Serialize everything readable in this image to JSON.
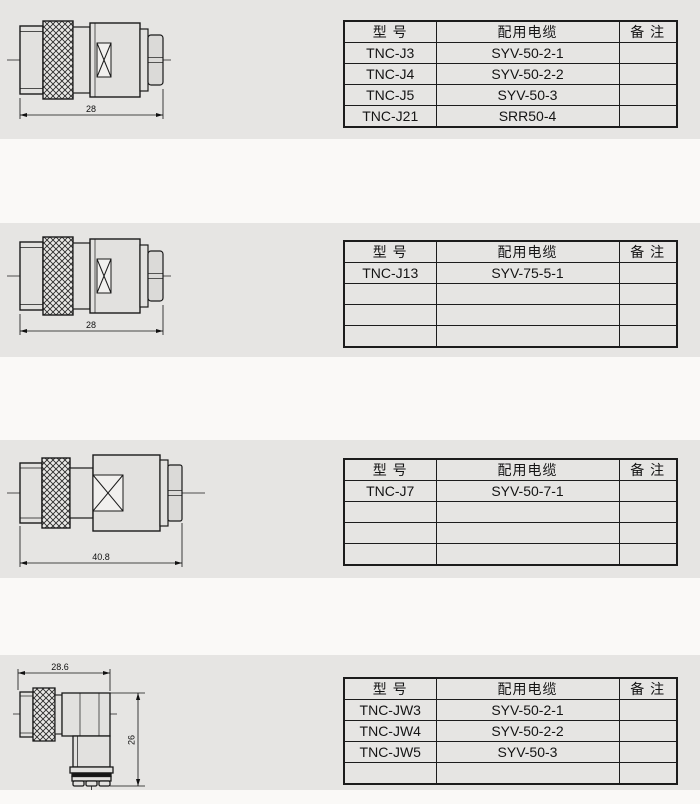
{
  "table_header": {
    "model": "型  号",
    "cable": "配用电缆",
    "remark": "备  注"
  },
  "sections": [
    {
      "drawing": {
        "kind": "straight-connector",
        "length": "28"
      },
      "rows": [
        {
          "model": "TNC-J3",
          "cable": "SYV-50-2-1",
          "remark": ""
        },
        {
          "model": "TNC-J4",
          "cable": "SYV-50-2-2",
          "remark": ""
        },
        {
          "model": "TNC-J5",
          "cable": "SYV-50-3",
          "remark": ""
        },
        {
          "model": "TNC-J21",
          "cable": "SRR50-4",
          "remark": ""
        }
      ]
    },
    {
      "drawing": {
        "kind": "straight-connector",
        "length": "28"
      },
      "rows": [
        {
          "model": "TNC-J13",
          "cable": "SYV-75-5-1",
          "remark": ""
        },
        {
          "model": "",
          "cable": "",
          "remark": ""
        },
        {
          "model": "",
          "cable": "",
          "remark": ""
        },
        {
          "model": "",
          "cable": "",
          "remark": ""
        }
      ]
    },
    {
      "drawing": {
        "kind": "straight-connector-large",
        "length": "40.8"
      },
      "rows": [
        {
          "model": "TNC-J7",
          "cable": "SYV-50-7-1",
          "remark": ""
        },
        {
          "model": "",
          "cable": "",
          "remark": ""
        },
        {
          "model": "",
          "cable": "",
          "remark": ""
        },
        {
          "model": "",
          "cable": "",
          "remark": ""
        }
      ]
    },
    {
      "drawing": {
        "kind": "right-angle-connector",
        "width": "28.6",
        "height": "26"
      },
      "rows": [
        {
          "model": "TNC-JW3",
          "cable": "SYV-50-2-1",
          "remark": ""
        },
        {
          "model": "TNC-JW4",
          "cable": "SYV-50-2-2",
          "remark": ""
        },
        {
          "model": "TNC-JW5",
          "cable": "SYV-50-3",
          "remark": ""
        },
        {
          "model": "",
          "cable": "",
          "remark": ""
        }
      ]
    }
  ]
}
